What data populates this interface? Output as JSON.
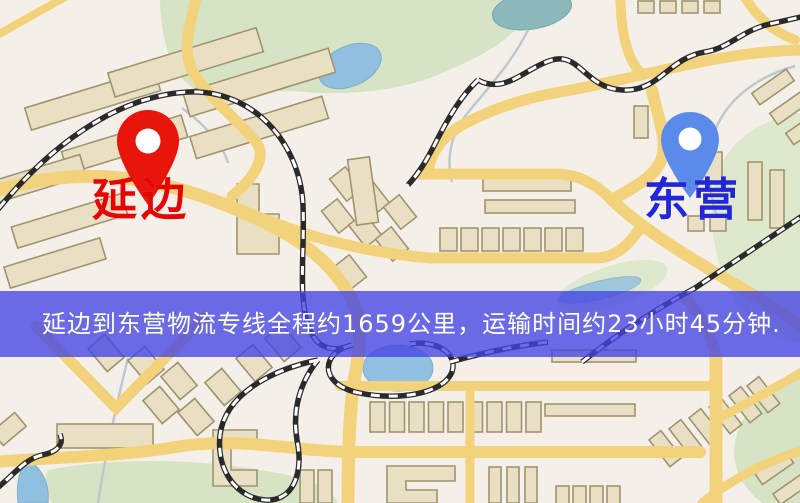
{
  "markers": {
    "origin": {
      "label": "延边"
    },
    "destination": {
      "label": "东营"
    }
  },
  "banner": {
    "text": "延边到东营物流专线全程约1659公里，运输时间约23小时45分钟."
  },
  "colors": {
    "origin_label": "#e60404",
    "origin_pin": "#e8150a",
    "destination_label": "#2126d6",
    "destination_pin": "#5b8bea",
    "banner_background_rgba": "rgba(68,68,228,0.78)",
    "banner_text": "#ffffff",
    "map_background": "#f5efea",
    "road": "#f2d27b",
    "building": "#e9e0c4",
    "park": "#d6e3c4",
    "water": "#90bfe0",
    "railway": "#2a2a2a"
  }
}
